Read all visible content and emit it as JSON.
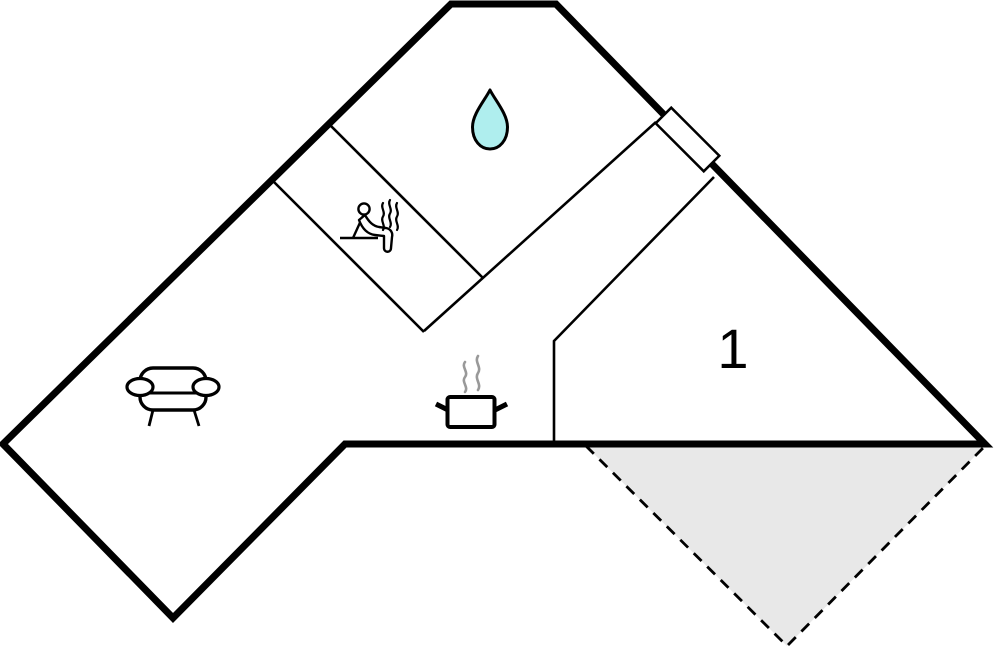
{
  "page": {
    "background": "#ffffff",
    "description": "Floor plan drawing of an angled holiday home with bathroom, sauna, living room, kitchen area, bedroom 1 and a dashed terrace"
  },
  "colors": {
    "ink": "#000000",
    "room_fill": "#ffffff",
    "terrace_fill": "#e8e8e8",
    "water": "#afeeee",
    "steam_gray": "#999999"
  },
  "floorplan": {
    "canvas": {
      "width": 998,
      "height": 652
    },
    "outer_wall": {
      "name": "building-outline",
      "stroke_width": 7,
      "points": [
        [
          451,
          4
        ],
        [
          556,
          4
        ],
        [
          985,
          444
        ],
        [
          345,
          444
        ],
        [
          173,
          618
        ],
        [
          3,
          444
        ]
      ]
    },
    "inner_wall_stroke_width": 2.6,
    "inner_walls": [
      {
        "name": "sauna-wall-upper",
        "points": [
          [
            329,
            124
          ],
          [
            483,
            278
          ]
        ]
      },
      {
        "name": "sauna-wall-lower",
        "points": [
          [
            272,
            180
          ],
          [
            424,
            332
          ]
        ]
      },
      {
        "name": "hallway-wall-west",
        "points": [
          [
            424,
            331
          ],
          [
            656,
            122
          ]
        ]
      },
      {
        "name": "bedroom-wall",
        "points": [
          [
            714,
            177
          ],
          [
            554,
            341
          ],
          [
            554,
            444
          ]
        ]
      }
    ],
    "door": {
      "name": "door-marker",
      "cx": 687.5,
      "cy": 139.5,
      "length": 68,
      "thickness": 22,
      "rotation_deg": 45,
      "stroke_width": 2.5
    },
    "terrace": {
      "name": "terrace-area",
      "points": [
        [
          586,
          446
        ],
        [
          985,
          446
        ],
        [
          787,
          646
        ]
      ],
      "dashed_edge": [
        [
          586,
          446
        ],
        [
          787,
          646
        ],
        [
          985,
          446
        ]
      ],
      "dash_pattern": "11 8",
      "stroke_width": 2.8
    },
    "rooms": [
      {
        "label": "1",
        "x": 733,
        "y": 347,
        "font_size": 56
      }
    ],
    "icons": [
      {
        "name": "water-drop",
        "meaning": "bathroom",
        "x": 490,
        "y": 121
      },
      {
        "name": "sauna",
        "meaning": "sauna",
        "x": 369,
        "y": 229
      },
      {
        "name": "sofa",
        "meaning": "living-room",
        "x": 173,
        "y": 396
      },
      {
        "name": "pot",
        "meaning": "kitchen",
        "x": 471,
        "y": 400
      }
    ]
  }
}
